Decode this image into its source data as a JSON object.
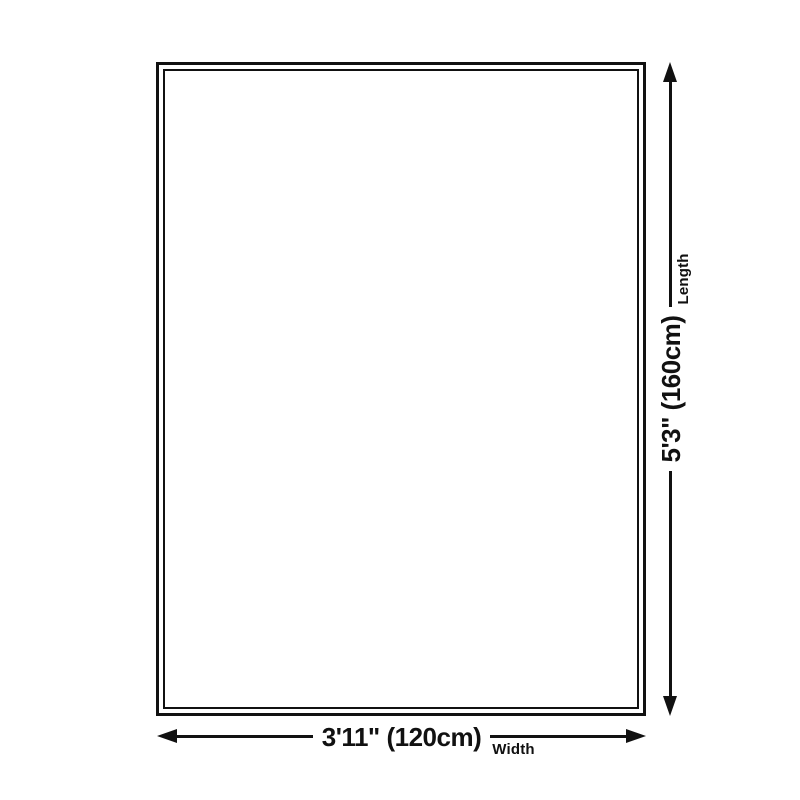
{
  "diagram": {
    "kind": "product-dimensions",
    "background_color": "#ffffff",
    "line_color": "#111111",
    "outline": {
      "shape": "rectangle",
      "border_style": "double"
    },
    "width": {
      "value": "3'11\" (120cm)",
      "label": "Width"
    },
    "length": {
      "value": "5'3\" (160cm)",
      "label": "Length"
    }
  }
}
